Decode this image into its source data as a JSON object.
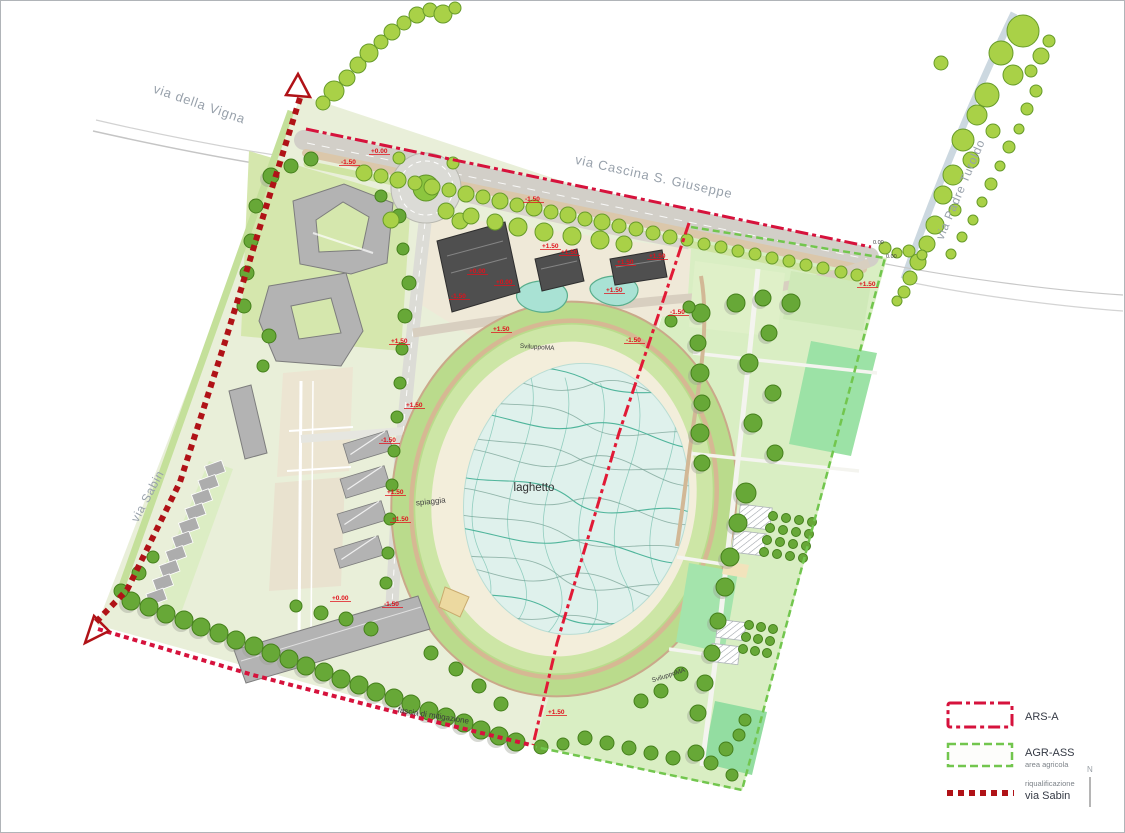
{
  "title": "masterplan site drawing",
  "streets": [
    {
      "id": "via-della-vigna",
      "label": "via della Vigna"
    },
    {
      "id": "via-cascina-s-giuseppe",
      "label": "via Cascina S. Giuseppe"
    },
    {
      "id": "via-padre-turoldo",
      "label": "via Padre Turoldo"
    },
    {
      "id": "via-sabin",
      "label": "via Sabin"
    }
  ],
  "site_labels": [
    {
      "t": "laghetto",
      "x": 533,
      "y": 490,
      "s": 11.5,
      "c": "#2f2f2f",
      "r": 0
    },
    {
      "t": "spiaggia",
      "x": 430,
      "y": 503,
      "s": 8,
      "c": "#444444",
      "r": -6
    },
    {
      "t": "fascia di mitigazione",
      "x": 432,
      "y": 717,
      "s": 8,
      "c": "#3c3c3c",
      "r": 9
    },
    {
      "t": "SviluppoMA",
      "x": 536,
      "y": 348,
      "s": 6.5,
      "c": "#3e3e3e",
      "r": 4
    },
    {
      "t": "SviluppoMA",
      "x": 668,
      "y": 676,
      "s": 6.5,
      "c": "#3e3e3e",
      "r": -18
    }
  ],
  "elevation_marks": [
    {
      "x": 340,
      "y": 163,
      "t": "-1.50"
    },
    {
      "x": 370,
      "y": 152,
      "t": "+0.00"
    },
    {
      "x": 524,
      "y": 200,
      "t": "-1.50"
    },
    {
      "x": 560,
      "y": 253,
      "t": "+1.50"
    },
    {
      "x": 605,
      "y": 291,
      "t": "+1.50"
    },
    {
      "x": 648,
      "y": 257,
      "t": "+1.50"
    },
    {
      "x": 669,
      "y": 313,
      "t": "-1.50"
    },
    {
      "x": 495,
      "y": 283,
      "t": "+0.00"
    },
    {
      "x": 450,
      "y": 297,
      "t": "-1.50"
    },
    {
      "x": 468,
      "y": 272,
      "t": "+0.00"
    },
    {
      "x": 541,
      "y": 247,
      "t": "+1.50"
    },
    {
      "x": 616,
      "y": 263,
      "t": "+1.50"
    },
    {
      "x": 858,
      "y": 285,
      "t": "+1.50"
    },
    {
      "x": 872,
      "y": 243,
      "t": "0.00",
      "d": 1
    },
    {
      "x": 885,
      "y": 257,
      "t": "0.00",
      "d": 1
    },
    {
      "x": 390,
      "y": 342,
      "t": "+1.50"
    },
    {
      "x": 492,
      "y": 330,
      "t": "+1.50"
    },
    {
      "x": 405,
      "y": 406,
      "t": "+1.50"
    },
    {
      "x": 380,
      "y": 441,
      "t": "-1.50"
    },
    {
      "x": 386,
      "y": 493,
      "t": "+1.50"
    },
    {
      "x": 391,
      "y": 520,
      "t": "+1.50"
    },
    {
      "x": 383,
      "y": 605,
      "t": "-1.50"
    },
    {
      "x": 331,
      "y": 599,
      "t": "+0.00"
    },
    {
      "x": 547,
      "y": 713,
      "t": "+1.50"
    },
    {
      "x": 625,
      "y": 341,
      "t": "-1.50"
    }
  ],
  "legend": {
    "items": [
      {
        "id": "ars-a",
        "label": "ARS-A",
        "sublabel": "",
        "color": "#d6123c"
      },
      {
        "id": "agr-ass",
        "label": "AGR-ASS",
        "sublabel": "area agricola",
        "color": "#72c64e"
      },
      {
        "id": "riqualificazione-via-sabin",
        "label": "via Sabin",
        "sublabel": "riqualificazione",
        "color": "#b01217"
      }
    ],
    "north_label": "N"
  },
  "colors": {
    "boundary_red": "#d6123c",
    "sabin_red": "#b01217",
    "agr_green": "#72c64e",
    "street_tree": "#a9d147",
    "park_tree": "#67a837",
    "water": "#dff1ec",
    "wave_teal": "#3fae92"
  },
  "map": {
    "trees": {
      "street": [
        [
          333,
          90,
          10
        ],
        [
          346,
          77,
          8
        ],
        [
          357,
          64,
          8
        ],
        [
          368,
          52,
          9
        ],
        [
          380,
          41,
          7
        ],
        [
          391,
          31,
          8
        ],
        [
          403,
          22,
          7
        ],
        [
          416,
          14,
          8
        ],
        [
          429,
          9,
          7
        ],
        [
          442,
          13,
          9
        ],
        [
          454,
          7,
          6
        ],
        [
          322,
          102,
          7
        ],
        [
          363,
          172,
          8
        ],
        [
          380,
          175,
          7
        ],
        [
          397,
          179,
          8
        ],
        [
          414,
          182,
          7
        ],
        [
          431,
          186,
          8
        ],
        [
          448,
          189,
          7
        ],
        [
          465,
          193,
          8
        ],
        [
          482,
          196,
          7
        ],
        [
          499,
          200,
          8
        ],
        [
          516,
          204,
          7
        ],
        [
          533,
          207,
          8
        ],
        [
          550,
          211,
          7
        ],
        [
          567,
          214,
          8
        ],
        [
          584,
          218,
          7
        ],
        [
          601,
          221,
          8
        ],
        [
          618,
          225,
          7
        ],
        [
          635,
          228,
          7
        ],
        [
          652,
          232,
          7
        ],
        [
          669,
          236,
          7
        ],
        [
          686,
          239,
          6
        ],
        [
          703,
          243,
          6
        ],
        [
          720,
          246,
          6
        ],
        [
          737,
          250,
          6
        ],
        [
          754,
          253,
          6
        ],
        [
          771,
          257,
          6
        ],
        [
          788,
          260,
          6
        ],
        [
          805,
          264,
          6
        ],
        [
          822,
          267,
          6
        ],
        [
          840,
          271,
          6
        ],
        [
          856,
          274,
          6
        ],
        [
          1022,
          30,
          16
        ],
        [
          1040,
          55,
          8
        ],
        [
          1000,
          52,
          12
        ],
        [
          1012,
          74,
          10
        ],
        [
          986,
          94,
          12
        ],
        [
          976,
          114,
          10
        ],
        [
          992,
          130,
          7
        ],
        [
          962,
          139,
          11
        ],
        [
          970,
          159,
          8
        ],
        [
          952,
          174,
          10
        ],
        [
          942,
          194,
          9
        ],
        [
          954,
          209,
          6
        ],
        [
          934,
          224,
          9
        ],
        [
          926,
          243,
          8
        ],
        [
          917,
          261,
          8
        ],
        [
          909,
          277,
          7
        ],
        [
          903,
          291,
          6
        ],
        [
          940,
          62,
          7
        ],
        [
          1035,
          90,
          6
        ],
        [
          1026,
          108,
          6
        ],
        [
          1018,
          128,
          5
        ],
        [
          1008,
          146,
          6
        ],
        [
          999,
          165,
          5
        ],
        [
          990,
          183,
          6
        ],
        [
          981,
          201,
          5
        ],
        [
          972,
          219,
          5
        ],
        [
          961,
          236,
          5
        ],
        [
          950,
          253,
          5
        ],
        [
          1048,
          40,
          6
        ],
        [
          1030,
          70,
          6
        ],
        [
          896,
          300,
          5
        ],
        [
          884,
          247,
          6
        ],
        [
          896,
          252,
          5
        ],
        [
          908,
          250,
          6
        ],
        [
          921,
          254,
          5
        ],
        [
          390,
          219,
          8
        ],
        [
          459,
          220,
          8
        ],
        [
          398,
          157,
          6
        ],
        [
          452,
          162,
          6
        ],
        [
          517,
          226,
          9
        ],
        [
          543,
          231,
          9
        ],
        [
          571,
          235,
          9
        ],
        [
          599,
          239,
          9
        ],
        [
          623,
          243,
          8
        ],
        [
          445,
          210,
          8
        ],
        [
          470,
          215,
          8
        ],
        [
          494,
          221,
          8
        ]
      ],
      "park": [
        [
          130,
          600,
          9
        ],
        [
          148,
          606,
          9
        ],
        [
          165,
          613,
          9
        ],
        [
          183,
          619,
          9
        ],
        [
          200,
          626,
          9
        ],
        [
          218,
          632,
          9
        ],
        [
          235,
          639,
          9
        ],
        [
          253,
          645,
          9
        ],
        [
          270,
          652,
          9
        ],
        [
          288,
          658,
          9
        ],
        [
          305,
          665,
          9
        ],
        [
          323,
          671,
          9
        ],
        [
          340,
          678,
          9
        ],
        [
          358,
          684,
          9
        ],
        [
          375,
          691,
          9
        ],
        [
          393,
          697,
          9
        ],
        [
          410,
          703,
          9
        ],
        [
          428,
          710,
          9
        ],
        [
          445,
          716,
          9
        ],
        [
          463,
          722,
          9
        ],
        [
          480,
          729,
          9
        ],
        [
          498,
          735,
          9
        ],
        [
          515,
          741,
          9
        ],
        [
          138,
          572,
          7
        ],
        [
          120,
          590,
          7
        ],
        [
          152,
          556,
          6
        ],
        [
          270,
          175,
          8
        ],
        [
          290,
          165,
          7
        ],
        [
          310,
          158,
          7
        ],
        [
          255,
          205,
          7
        ],
        [
          250,
          240,
          7
        ],
        [
          246,
          272,
          7
        ],
        [
          243,
          305,
          7
        ],
        [
          398,
          215,
          7
        ],
        [
          402,
          248,
          6
        ],
        [
          268,
          335,
          7
        ],
        [
          262,
          365,
          6
        ],
        [
          380,
          195,
          6
        ],
        [
          408,
          282,
          7
        ],
        [
          404,
          315,
          7
        ],
        [
          401,
          348,
          6
        ],
        [
          399,
          382,
          6
        ],
        [
          396,
          416,
          6
        ],
        [
          393,
          450,
          6
        ],
        [
          391,
          484,
          6
        ],
        [
          389,
          518,
          6
        ],
        [
          387,
          552,
          6
        ],
        [
          385,
          582,
          6
        ],
        [
          320,
          612,
          7
        ],
        [
          345,
          618,
          7
        ],
        [
          370,
          628,
          7
        ],
        [
          295,
          605,
          6
        ],
        [
          430,
          652,
          7
        ],
        [
          455,
          668,
          7
        ],
        [
          478,
          685,
          7
        ],
        [
          500,
          703,
          7
        ],
        [
          700,
          312,
          9
        ],
        [
          697,
          342,
          8
        ],
        [
          699,
          372,
          9
        ],
        [
          701,
          402,
          8
        ],
        [
          699,
          432,
          9
        ],
        [
          701,
          462,
          8
        ],
        [
          735,
          302,
          9
        ],
        [
          762,
          297,
          8
        ],
        [
          790,
          302,
          9
        ],
        [
          768,
          332,
          8
        ],
        [
          748,
          362,
          9
        ],
        [
          772,
          392,
          8
        ],
        [
          752,
          422,
          9
        ],
        [
          774,
          452,
          8
        ],
        [
          745,
          492,
          10
        ],
        [
          737,
          522,
          9
        ],
        [
          729,
          556,
          9
        ],
        [
          724,
          586,
          9
        ],
        [
          717,
          620,
          8
        ],
        [
          711,
          652,
          8
        ],
        [
          704,
          682,
          8
        ],
        [
          697,
          712,
          8
        ],
        [
          772,
          515,
          4.5
        ],
        [
          785,
          517,
          4.5
        ],
        [
          798,
          519,
          4.5
        ],
        [
          811,
          521,
          4.5
        ],
        [
          769,
          527,
          4.5
        ],
        [
          782,
          529,
          4.5
        ],
        [
          795,
          531,
          4.5
        ],
        [
          808,
          533,
          4.5
        ],
        [
          766,
          539,
          4.5
        ],
        [
          779,
          541,
          4.5
        ],
        [
          792,
          543,
          4.5
        ],
        [
          805,
          545,
          4.5
        ],
        [
          763,
          551,
          4.5
        ],
        [
          776,
          553,
          4.5
        ],
        [
          789,
          555,
          4.5
        ],
        [
          802,
          557,
          4.5
        ],
        [
          748,
          624,
          4.5
        ],
        [
          760,
          626,
          4.5
        ],
        [
          772,
          628,
          4.5
        ],
        [
          745,
          636,
          4.5
        ],
        [
          757,
          638,
          4.5
        ],
        [
          769,
          640,
          4.5
        ],
        [
          742,
          648,
          4.5
        ],
        [
          754,
          650,
          4.5
        ],
        [
          766,
          652,
          4.5
        ],
        [
          695,
          752,
          8
        ],
        [
          710,
          762,
          7
        ],
        [
          725,
          748,
          7
        ],
        [
          738,
          734,
          6
        ],
        [
          672,
          757,
          7
        ],
        [
          650,
          752,
          7
        ],
        [
          628,
          747,
          7
        ],
        [
          606,
          742,
          7
        ],
        [
          584,
          737,
          7
        ],
        [
          562,
          743,
          6
        ],
        [
          731,
          774,
          6
        ],
        [
          744,
          719,
          6
        ],
        [
          540,
          746,
          7
        ],
        [
          640,
          700,
          7
        ],
        [
          660,
          690,
          7
        ],
        [
          680,
          673,
          7
        ],
        [
          670,
          320,
          6
        ],
        [
          688,
          306,
          6
        ]
      ]
    }
  }
}
